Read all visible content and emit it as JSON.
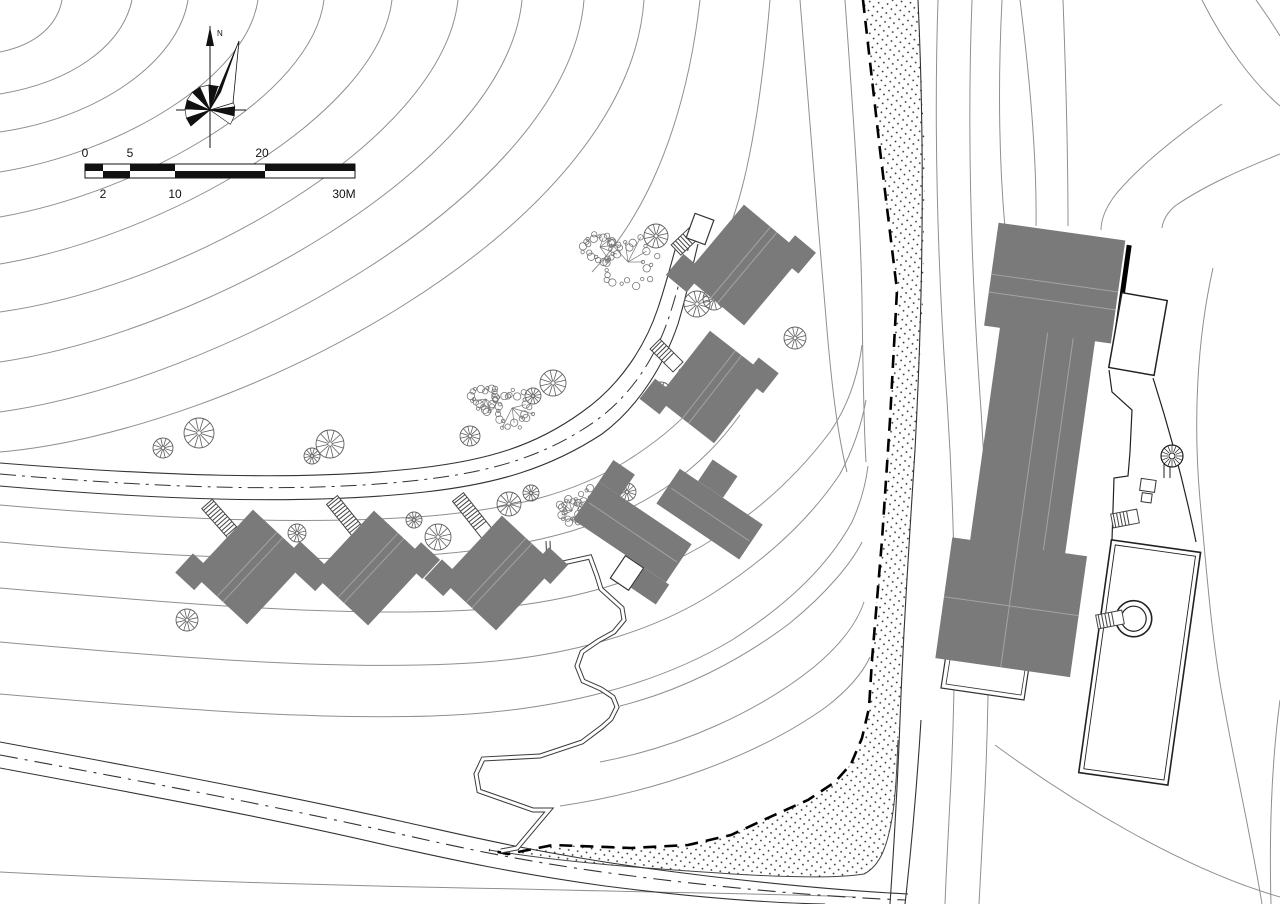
{
  "colors": {
    "background": "#ffffff",
    "contour": "#8f8f8f",
    "outline": "#2a2a2a",
    "building": "#7a7a7a",
    "ridge": "#a3a3a3",
    "tree": "#5f5f5f",
    "dot": "#111111"
  },
  "north": {
    "label": "N"
  },
  "scale_bar": {
    "segments_px": [
      85,
      103,
      130,
      175,
      265,
      355
    ],
    "labels_top": [
      {
        "text": "0",
        "x": 85
      },
      {
        "text": "5",
        "x": 130
      },
      {
        "text": "20",
        "x": 262
      }
    ],
    "labels_bottom": [
      {
        "text": "2",
        "x": 103
      },
      {
        "text": "10",
        "x": 175
      },
      {
        "text": "30M",
        "x": 344
      }
    ]
  },
  "features": {
    "cottages": [
      {
        "x": 250,
        "y": 567,
        "rot": 43,
        "s": 1,
        "kind": "cross"
      },
      {
        "x": 371,
        "y": 568,
        "rot": 43,
        "s": 1,
        "kind": "cross"
      },
      {
        "x": 499,
        "y": 573,
        "rot": 43,
        "s": 1,
        "kind": "cross"
      },
      {
        "x": 712,
        "y": 387,
        "rot": 38,
        "s": 0.98,
        "kind": "cross"
      },
      {
        "x": 744,
        "y": 265,
        "rot": 40,
        "s": 1.05,
        "kind": "cross"
      },
      {
        "x": 664,
        "y": 528,
        "rot": 34,
        "s": 1,
        "kind": "slabs"
      }
    ],
    "stairs": [
      {
        "x1": 207,
        "y1": 504,
        "x2": 247,
        "y2": 549
      },
      {
        "x1": 332,
        "y1": 500,
        "x2": 370,
        "y2": 547
      },
      {
        "x1": 458,
        "y1": 497,
        "x2": 496,
        "y2": 545
      },
      {
        "x1": 655,
        "y1": 344,
        "x2": 678,
        "y2": 367
      },
      {
        "x1": 676,
        "y1": 250,
        "x2": 695,
        "y2": 232
      },
      {
        "x1": 1112,
        "y1": 521,
        "x2": 1138,
        "y2": 516
      },
      {
        "x1": 1097,
        "y1": 622,
        "x2": 1123,
        "y2": 617
      }
    ],
    "platforms": [
      {
        "x": 700,
        "y": 229,
        "rot": 20,
        "w": 20,
        "h": 26
      },
      {
        "x": 627,
        "y": 573,
        "rot": 34,
        "w": 22,
        "h": 27
      }
    ],
    "entry_dots": [
      [
        241,
        545
      ],
      [
        364,
        543
      ],
      [
        490,
        541
      ],
      [
        681,
        371
      ],
      [
        701,
        231
      ],
      [
        633,
        578
      ]
    ],
    "spiral_stairs": [
      {
        "x": 1172,
        "y": 456,
        "r": 11
      }
    ],
    "trees_round": [
      [
        163,
        448,
        10
      ],
      [
        199,
        433,
        15
      ],
      [
        330,
        444,
        14
      ],
      [
        312,
        456,
        8
      ],
      [
        297,
        533,
        9
      ],
      [
        187,
        620,
        11
      ],
      [
        414,
        520,
        8
      ],
      [
        438,
        537,
        13
      ],
      [
        470,
        436,
        10
      ],
      [
        509,
        504,
        12
      ],
      [
        531,
        493,
        8
      ],
      [
        553,
        383,
        13
      ],
      [
        533,
        396,
        8
      ],
      [
        656,
        236,
        12
      ],
      [
        697,
        304,
        13
      ],
      [
        714,
        299,
        11
      ],
      [
        795,
        338,
        11
      ],
      [
        661,
        392,
        10
      ],
      [
        627,
        492,
        9
      ]
    ],
    "trees_organic": [
      [
        628,
        262,
        30
      ],
      [
        600,
        247,
        19
      ],
      [
        512,
        408,
        26
      ],
      [
        486,
        399,
        16
      ],
      [
        597,
        505,
        22
      ],
      [
        572,
        511,
        14
      ]
    ]
  }
}
